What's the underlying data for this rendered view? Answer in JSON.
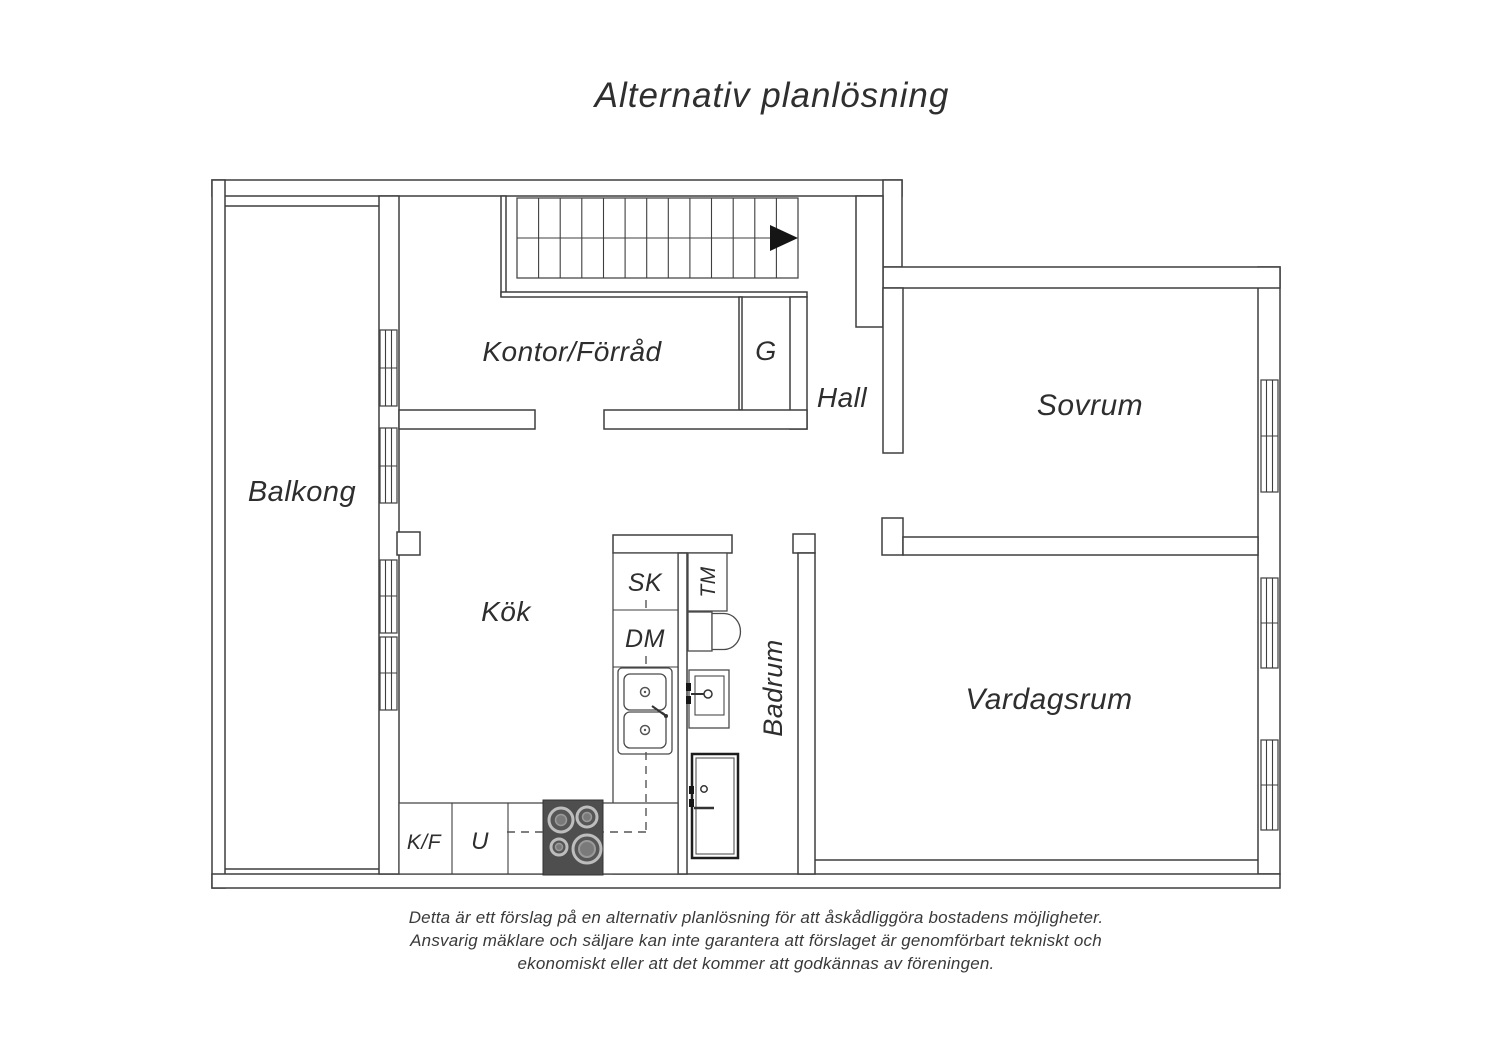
{
  "page": {
    "title": "Alternativ planlösning",
    "disclaimer": [
      "Detta är ett förslag på en alternativ planlösning för att åskådliggöra bostadens möjligheter.",
      "Ansvarig mäklare och säljare kan inte garantera att förslaget är genomförbart tekniskt och",
      "ekonomiskt eller att det kommer att godkännas av föreningen."
    ]
  },
  "rooms": {
    "balkong": "Balkong",
    "kontor_forrad": "Kontor/Förråd",
    "garderob": "G",
    "hall": "Hall",
    "sovrum": "Sovrum",
    "kok": "Kök",
    "badrum": "Badrum",
    "vardagsrum": "Vardagsrum"
  },
  "fixtures": {
    "sk": "SK",
    "dm": "DM",
    "tm": "TM",
    "kf": "K/F",
    "u": "U"
  },
  "colors": {
    "wall_line": "#3f3f3f",
    "label_text": "#2e2e2e",
    "stove_panel": "#4e4e4e",
    "stair_arrow": "#151515"
  }
}
